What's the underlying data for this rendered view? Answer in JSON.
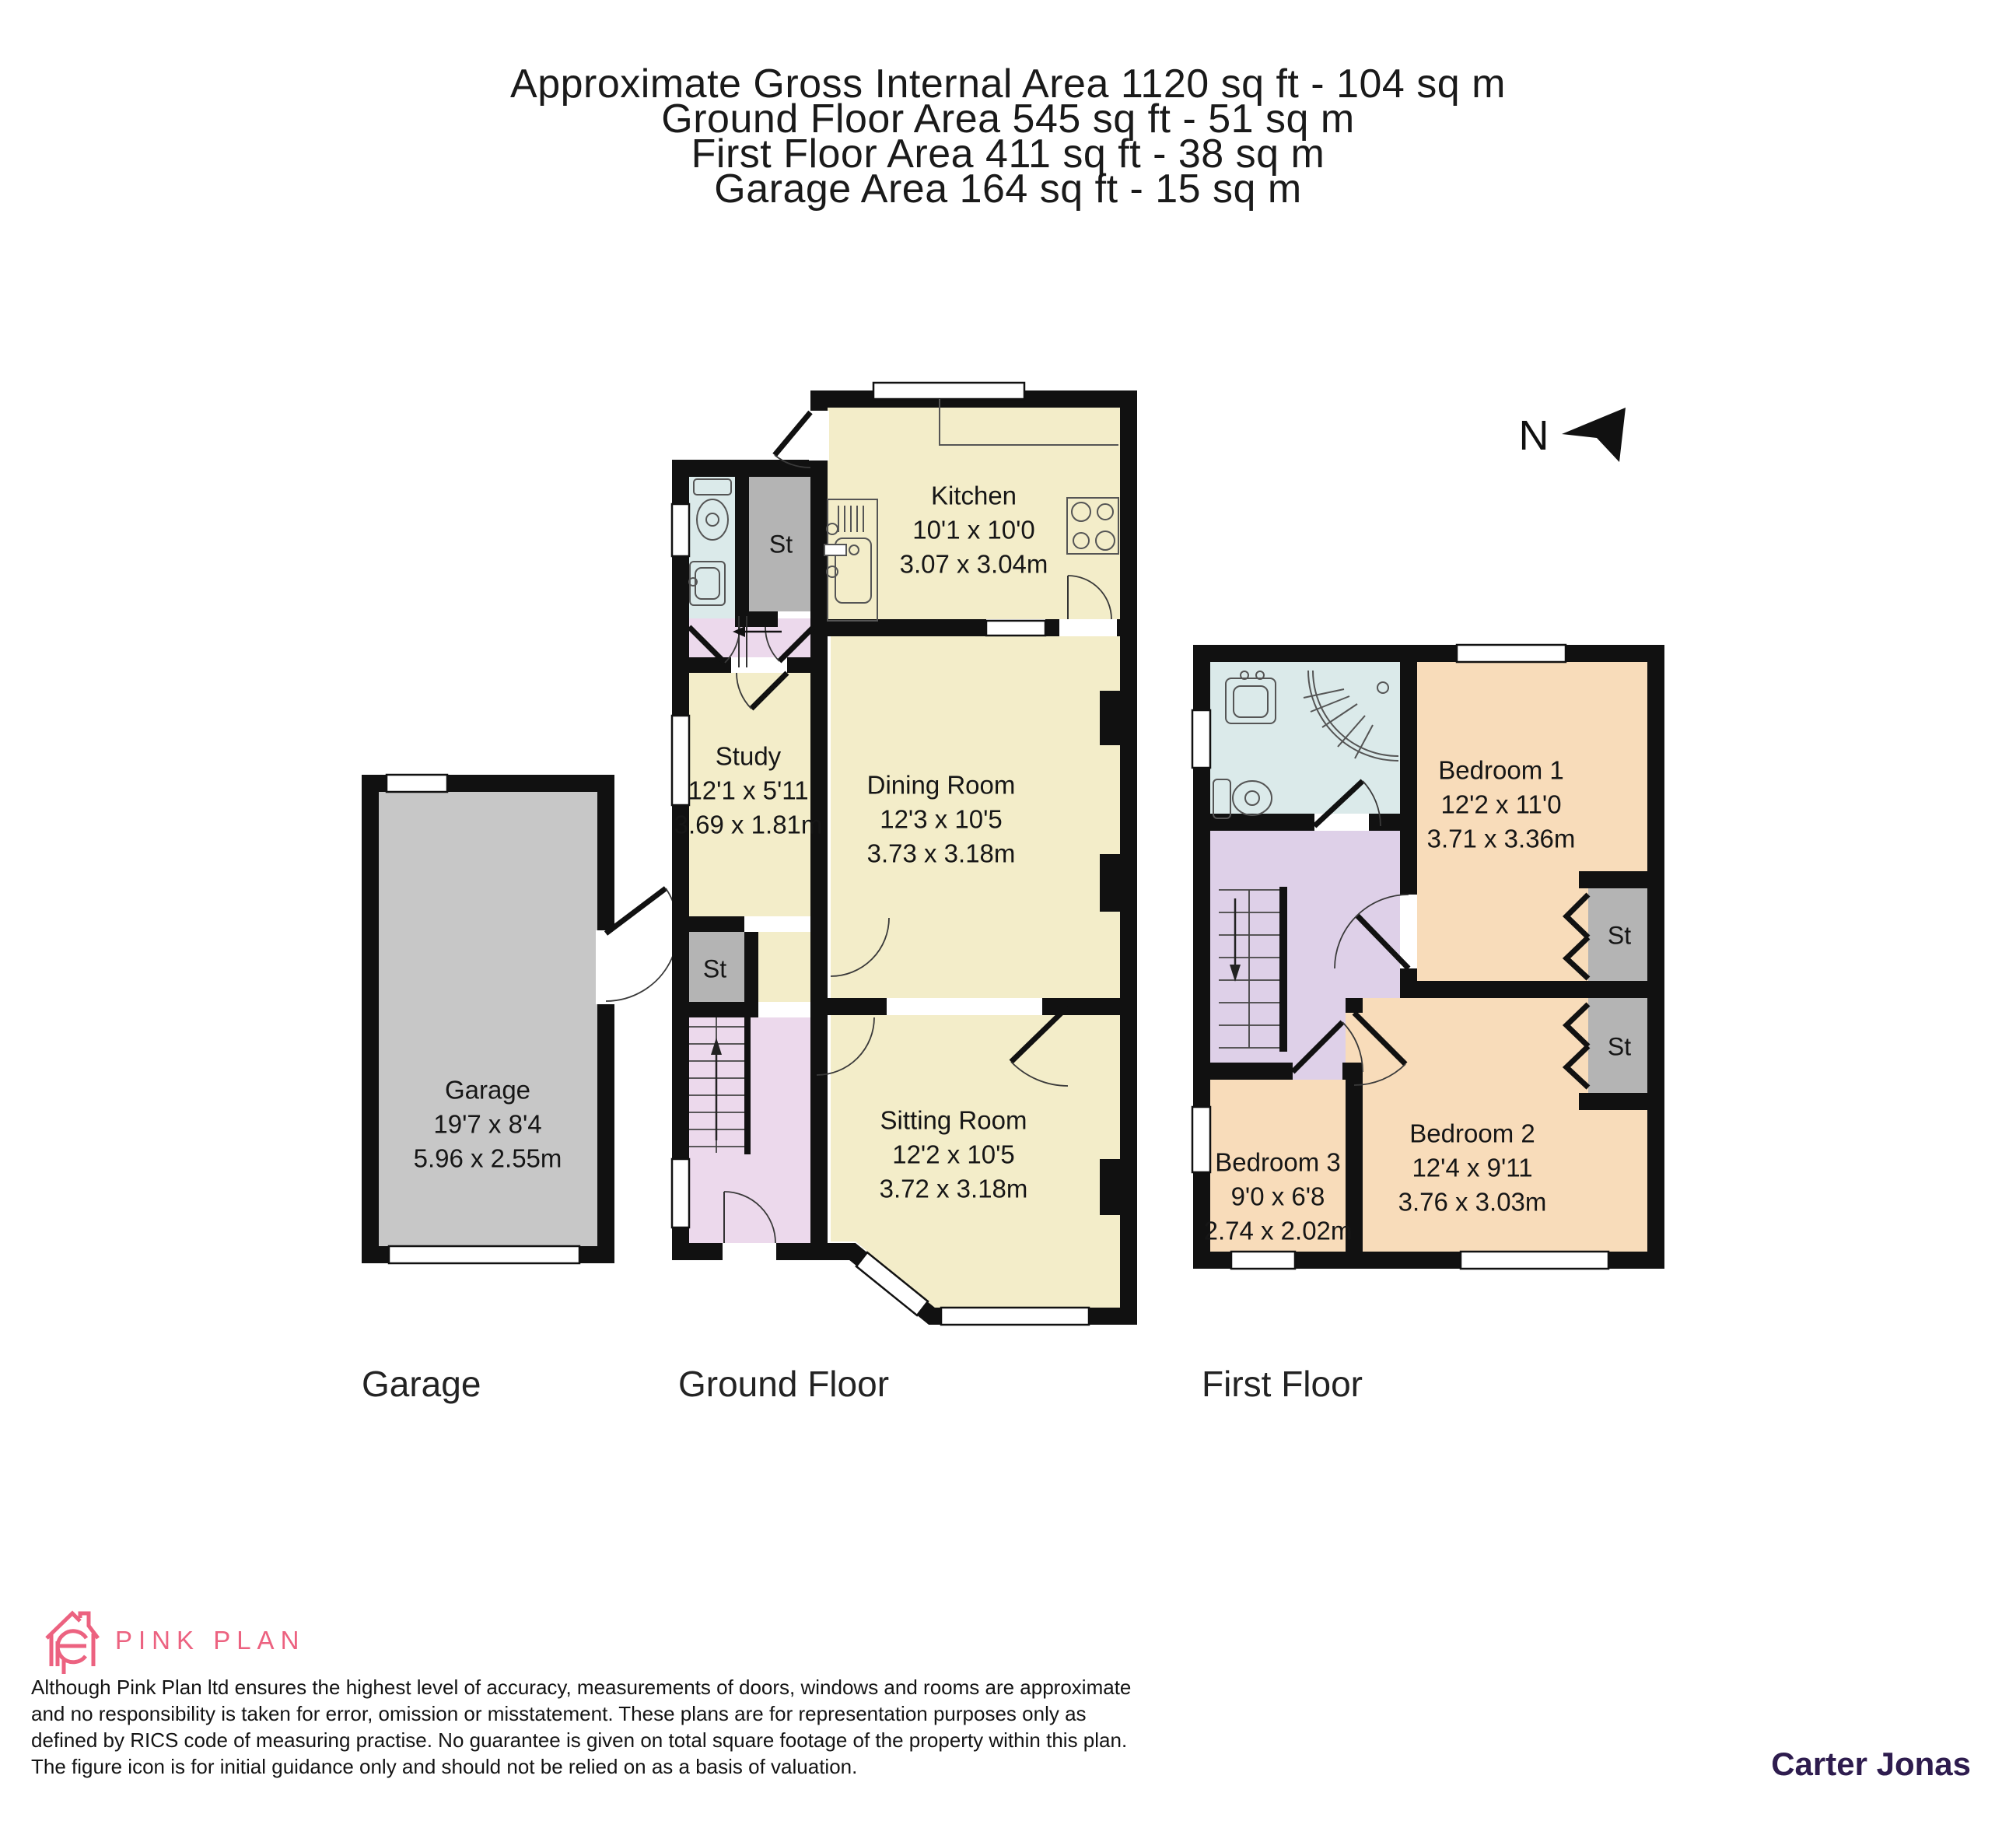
{
  "header": {
    "line1": "Approximate Gross Internal Area 1120 sq ft - 104 sq m",
    "line2": "Ground Floor Area 545 sq ft - 51 sq m",
    "line3": "First Floor Area 411 sq ft - 38 sq m",
    "line4": "Garage Area 164 sq ft - 15 sq m"
  },
  "north_label": "N",
  "floor_labels": {
    "garage": "Garage",
    "ground": "Ground Floor",
    "first": "First Floor"
  },
  "rooms": {
    "garage": {
      "name": "Garage",
      "ft": "19'7 x 8'4",
      "m": "5.96 x 2.55m"
    },
    "kitchen": {
      "name": "Kitchen",
      "ft": "10'1 x 10'0",
      "m": "3.07 x 3.04m"
    },
    "study": {
      "name": "Study",
      "ft": "12'1 x 5'11",
      "m": "3.69 x 1.81m"
    },
    "dining": {
      "name": "Dining Room",
      "ft": "12'3 x 10'5",
      "m": "3.73 x 3.18m"
    },
    "sitting": {
      "name": "Sitting Room",
      "ft": "12'2 x 10'5",
      "m": "3.72 x 3.18m"
    },
    "bedroom1": {
      "name": "Bedroom 1",
      "ft": "12'2 x 11'0",
      "m": "3.71 x 3.36m"
    },
    "bedroom2": {
      "name": "Bedroom 2",
      "ft": "12'4 x 9'11",
      "m": "3.76 x 3.03m"
    },
    "bedroom3": {
      "name": "Bedroom 3",
      "ft": "9'0 x 6'8",
      "m": "2.74 x 2.02m"
    },
    "storage": "St"
  },
  "footer": {
    "logo_text": "PINK PLAN",
    "disclaimer": "Although Pink Plan ltd ensures the highest level of accuracy, measurements of doors, windows and rooms are approximate and no responsibility is taken for error, omission or misstatement. These plans are for representation purposes only as defined by RICS code of measuring practise. No guarantee is given on total square footage of the property within this plan. The figure icon is for initial guidance only and should not be relied on as a basis of valuation.",
    "brand": "Carter Jonas"
  },
  "colors": {
    "wall": "#111111",
    "room_cream": "#f3edc9",
    "room_peach": "#f8dcba",
    "hall_lavender": "#ecd9ec",
    "landing_lavender": "#ded0e8",
    "bath_blue": "#dbeaea",
    "storage_grey": "#b4b4b4",
    "garage_grey": "#c7c7c7",
    "logo_pink": "#ec6280",
    "brand_purple": "#2e1c4e"
  }
}
